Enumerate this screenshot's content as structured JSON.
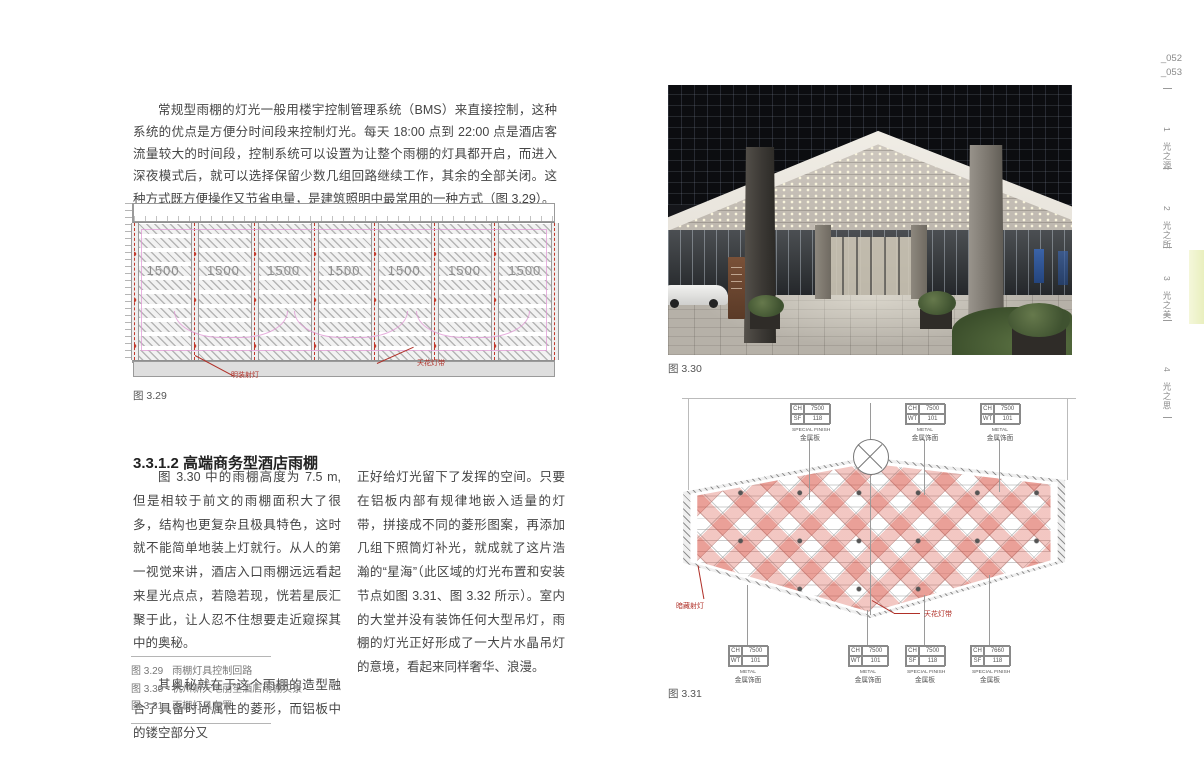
{
  "page": {
    "page_numbers": [
      "_052",
      "_053"
    ],
    "side_tabs": [
      {
        "num": "1",
        "label": "光之源",
        "active": false
      },
      {
        "num": "2",
        "label": "光之所",
        "active": false
      },
      {
        "num": "3",
        "label": "光之美",
        "active": true
      },
      {
        "num": "4",
        "label": "光之思",
        "active": false
      }
    ],
    "active_tab_color": "#e9efbe"
  },
  "intro_paragraph": "常规型雨棚的灯光一般用楼宇控制管理系统（BMS）来直接控制，这种系统的优点是方便分时间段来控制灯光。每天 18:00 点到 22:00 点是酒店客流量较大的时间段，控制系统可以设置为让整个雨棚的灯具都开启，而进入深夜模式后，就可以选择保留少数几组回路继续工作，其余的全部关闭。这种方式既方便操作又节省电量，是建筑照明中最常用的一种方式（图 3.29）。",
  "section": {
    "heading": "3.3.1.2  高端商务型酒店雨棚",
    "col1_p1": "图 3.30 中的雨棚高度为 7.5 m, 但是相较于前文的雨棚面积大了很多，结构也更复杂且极具特色，这时就不能简单地装上灯就行。从人的第一视觉来讲，酒店入口雨棚远远看起来星光点点，若隐若现，恍若星辰汇聚于此，让人忍不住想要走近窥探其中的奥秘。",
    "col1_p2": "其奥秘就在于这个雨棚的造型融合了具备时尚属性的菱形，而铝板中的镂空部分又",
    "col2_p1": "正好给灯光留下了发挥的空间。只要在铝板内部有规律地嵌入适量的灯带，拼接成不同的菱形图案，再添加几组下照筒灯补光，就成就了这片浩瀚的“星海”（此区域的灯光布置和安装节点如图 3.31、图 3.32 所示）。室内的大堂并没有装饰任何大型吊灯，雨棚的灯光正好形成了一大片水晶吊灯的意境，看起来同样奢华、浪漫。"
  },
  "caption_list": [
    {
      "fig": "图 3.29",
      "text": "雨棚灯具控制回路"
    },
    {
      "fig": "图 3.30",
      "text": "杭州新天地丽笙酒店雨棚实景"
    },
    {
      "fig": "图 3.31",
      "text": "雨棚灯具布置"
    }
  ],
  "figure_329": {
    "caption": "图 3.29",
    "dimensions": [
      "1500",
      "1500",
      "1500",
      "1500",
      "1500",
      "1500",
      "1500"
    ],
    "label_spotlight": "明装射灯",
    "label_strip": "天花灯带",
    "annotation_color": "#b03028"
  },
  "figure_330": {
    "caption": "图 3.30"
  },
  "figure_331": {
    "caption": "图 3.31",
    "label_spotlight": "暗藏射灯",
    "label_strip": "天花灯带",
    "callouts_top": [
      {
        "rows": [
          [
            "CH",
            "7500"
          ],
          [
            "SF",
            "118"
          ]
        ],
        "finish_en": "SPECIAL FINISH",
        "finish_cn": "金属板"
      },
      {
        "rows": [
          [
            "CH",
            "7500"
          ],
          [
            "WT",
            "101"
          ]
        ],
        "finish_en": "METAL",
        "finish_cn": "金属饰面"
      },
      {
        "rows": [
          [
            "CH",
            "7500"
          ],
          [
            "WT",
            "101"
          ]
        ],
        "finish_en": "METAL",
        "finish_cn": "金属饰面"
      }
    ],
    "callouts_bottom": [
      {
        "rows": [
          [
            "CH",
            "7500"
          ],
          [
            "WT",
            "101"
          ]
        ],
        "finish_en": "METAL",
        "finish_cn": "金属饰面"
      },
      {
        "rows": [
          [
            "CH",
            "7500"
          ],
          [
            "WT",
            "101"
          ]
        ],
        "finish_en": "METAL",
        "finish_cn": "金属饰面"
      },
      {
        "rows": [
          [
            "CH",
            "7500"
          ],
          [
            "SF",
            "118"
          ]
        ],
        "finish_en": "SPECIAL FINISH",
        "finish_cn": "金属板"
      },
      {
        "rows": [
          [
            "CH",
            "7660"
          ],
          [
            "SF",
            "118"
          ]
        ],
        "finish_en": "SPECIAL FINISH",
        "finish_cn": "金属板"
      }
    ]
  }
}
